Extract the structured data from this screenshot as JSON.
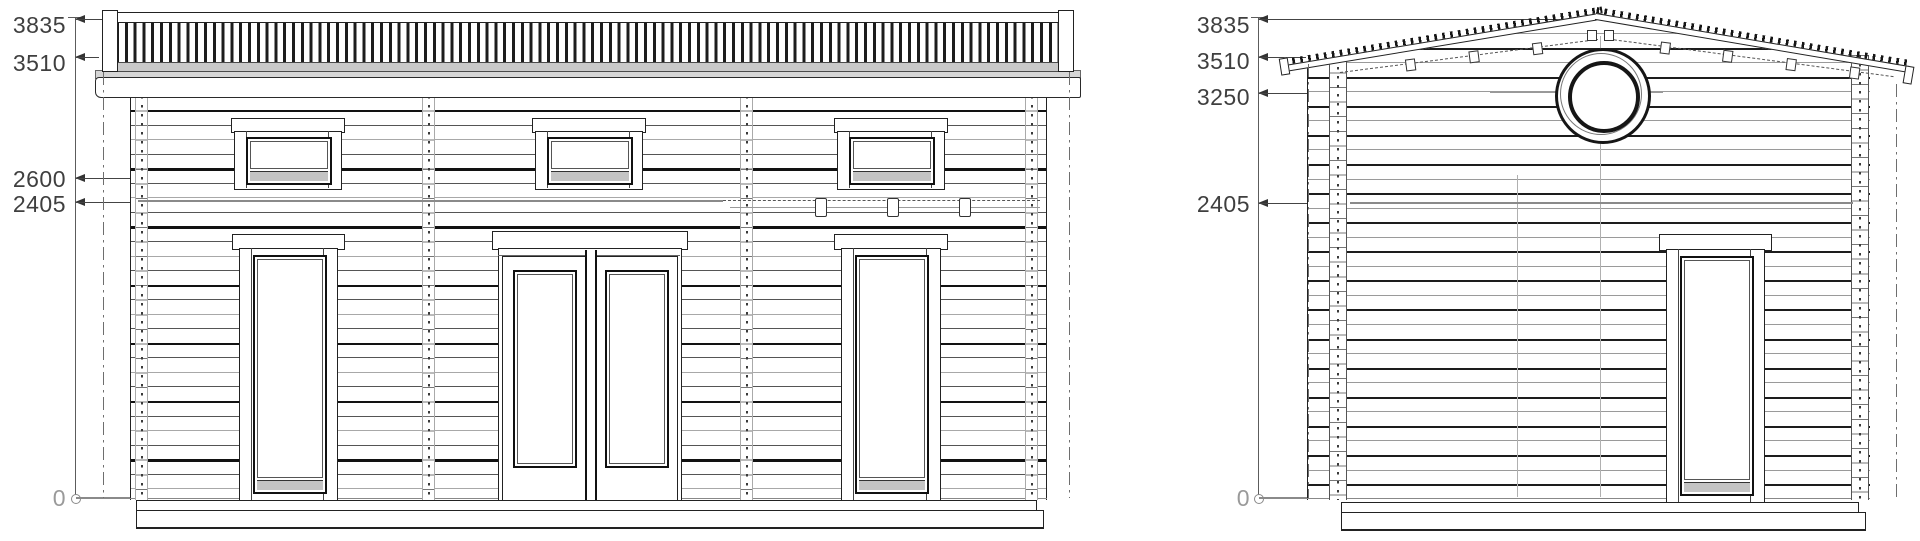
{
  "drawing": {
    "colors": {
      "line": "#1a1a1a",
      "faint_line": "#9a9a9a",
      "gray_leader": "#8a8a8a",
      "dim_text": "#3f3f3f",
      "zero_text": "#9a9a9a",
      "background": "#ffffff"
    },
    "front_elevation": {
      "dims": [
        "3835",
        "3510",
        "2600",
        "2405",
        "0"
      ],
      "levels_mm": [
        3835,
        3510,
        2600,
        2405,
        0
      ]
    },
    "side_elevation": {
      "dims": [
        "3835",
        "3510",
        "3250",
        "2405",
        "0"
      ],
      "levels_mm": [
        3835,
        3510,
        3250,
        2405,
        0
      ]
    }
  }
}
